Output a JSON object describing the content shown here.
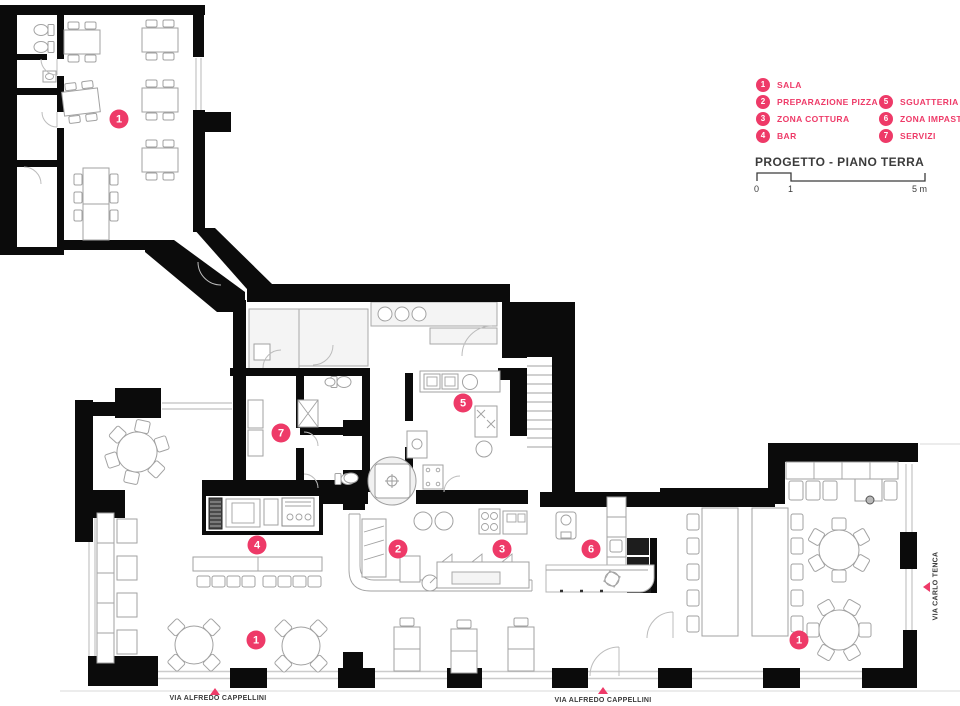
{
  "colors": {
    "accent": "#ee3a68",
    "ink": "#3b3b3b",
    "wall": "#0b0b0b"
  },
  "legend": {
    "col1": [
      {
        "num": "1",
        "label": "SALA"
      },
      {
        "num": "2",
        "label": "PREPARAZIONE PIZZA"
      },
      {
        "num": "3",
        "label": "ZONA COTTURA"
      },
      {
        "num": "4",
        "label": "BAR"
      }
    ],
    "col2": [
      {
        "num": "5",
        "label": "SGUATTERIA"
      },
      {
        "num": "6",
        "label": "ZONA IMPASTI"
      },
      {
        "num": "7",
        "label": "SERVIZI"
      }
    ]
  },
  "title": "PROGETTO - PIANO TERRA",
  "scalebar": {
    "t0": "0",
    "t1": "1",
    "t5": "5 m"
  },
  "streets": {
    "bottom_left": "VIA ALFREDO CAPPELLINI",
    "bottom_center": "VIA ALFREDO CAPPELLINI",
    "right": "VIA CARLO TENCA"
  },
  "plan_markers": [
    {
      "num": "1",
      "x": 119,
      "y": 119
    },
    {
      "num": "7",
      "x": 281,
      "y": 433
    },
    {
      "num": "5",
      "x": 463,
      "y": 403
    },
    {
      "num": "4",
      "x": 257,
      "y": 545
    },
    {
      "num": "2",
      "x": 398,
      "y": 549
    },
    {
      "num": "3",
      "x": 502,
      "y": 549
    },
    {
      "num": "6",
      "x": 591,
      "y": 549
    },
    {
      "num": "1",
      "x": 256,
      "y": 640
    },
    {
      "num": "1",
      "x": 799,
      "y": 640
    }
  ]
}
